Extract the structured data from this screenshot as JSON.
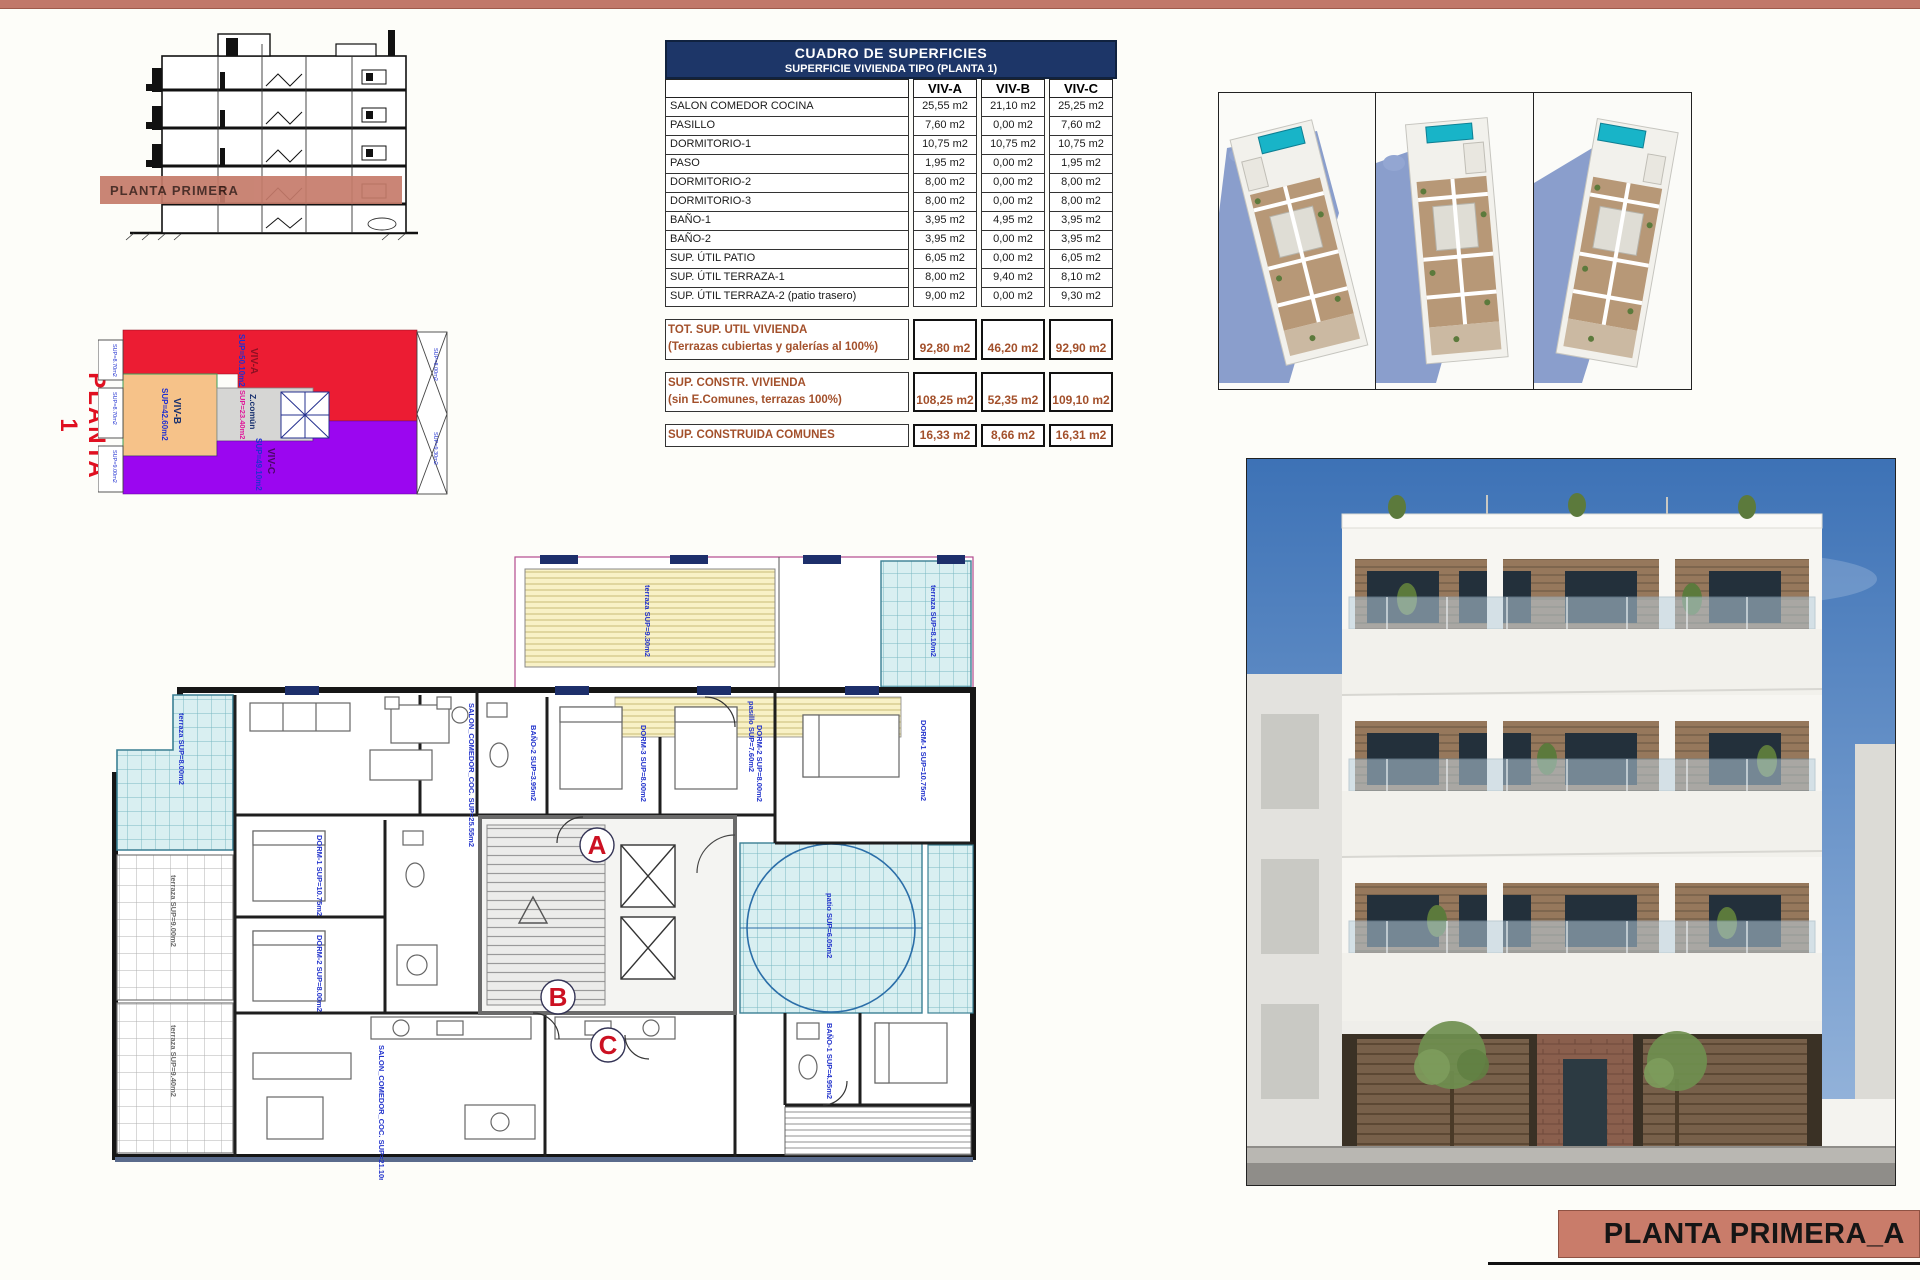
{
  "page": {
    "top_bar_color": "#c1786a",
    "accent_salmon": "#c97c6a",
    "table_header_navy": "#1d3668",
    "summary_brown": "#a3502b"
  },
  "section": {
    "band_label": "PLANTA PRIMERA"
  },
  "diagram": {
    "title": "PLANTA 1",
    "zones": {
      "viva": {
        "name": "VIV-A",
        "sup": "SUP=50.10m2",
        "color": "#ec1c33"
      },
      "vivb": {
        "name": "VIV-B",
        "sup": "SUP=42.60m2",
        "color": "#f6c289"
      },
      "zcomun": {
        "name": "Z.común",
        "sup": "SUP=23.40m2",
        "color": "#d6d6d4"
      },
      "vivc": {
        "name": "VIV-C",
        "sup": "SUP=49.10m2",
        "color": "#9b06f0"
      }
    },
    "edge_labels": {
      "left1": "SUP=8.70m2",
      "left2": "SUP=8.70m2",
      "left3": "SUP=9.00m2",
      "right1": "SUP=8.00m2",
      "right2": "SUP=9.30m2"
    }
  },
  "table": {
    "title": "CUADRO DE SUPERFICIES",
    "subtitle": "SUPERFICIE VIVIENDA TIPO  (PLANTA 1)",
    "col_a": "VIV-A",
    "col_b": "VIV-B",
    "col_c": "VIV-C",
    "rows": [
      {
        "label": "SALON COMEDOR COCINA",
        "a": "25,55 m2",
        "b": "21,10 m2",
        "c": "25,25 m2"
      },
      {
        "label": "PASILLO",
        "a": "7,60 m2",
        "b": "0,00 m2",
        "c": "7,60 m2"
      },
      {
        "label": "DORMITORIO-1",
        "a": "10,75 m2",
        "b": "10,75 m2",
        "c": "10,75 m2"
      },
      {
        "label": "PASO",
        "a": "1,95 m2",
        "b": "0,00 m2",
        "c": "1,95 m2"
      },
      {
        "label": "DORMITORIO-2",
        "a": "8,00 m2",
        "b": "0,00 m2",
        "c": "8,00 m2"
      },
      {
        "label": "DORMITORIO-3",
        "a": "8,00 m2",
        "b": "0,00 m2",
        "c": "8,00 m2"
      },
      {
        "label": "BAÑO-1",
        "a": "3,95 m2",
        "b": "4,95 m2",
        "c": "3,95 m2"
      },
      {
        "label": "BAÑO-2",
        "a": "3,95 m2",
        "b": "0,00 m2",
        "c": "3,95 m2"
      },
      {
        "label": "SUP. ÚTIL PATIO",
        "a": "6,05 m2",
        "b": "0,00 m2",
        "c": "6,05 m2"
      },
      {
        "label": "SUP. ÚTIL TERRAZA-1",
        "a": "8,00 m2",
        "b": "9,40 m2",
        "c": "8,10 m2"
      },
      {
        "label": "SUP. ÚTIL TERRAZA-2 (patio trasero)",
        "a": "9,00 m2",
        "b": "0,00 m2",
        "c": "9,30 m2"
      }
    ],
    "summary": [
      {
        "l1": "TOT. SUP. UTIL VIVIENDA",
        "l2": "(Terrazas cubiertas y galerías al 100%)",
        "a": "92,80 m2",
        "b": "46,20 m2",
        "c": "92,90 m2"
      },
      {
        "l1": "SUP. CONSTR. VIVIENDA",
        "l2": "(sin E.Comunes, terrazas 100%)",
        "a": "108,25 m2",
        "b": "52,35 m2",
        "c": "109,10 m2"
      },
      {
        "l1": "SUP. CONSTRUIDA COMUNES",
        "l2": "",
        "a": "16,33 m2",
        "b": "8,66 m2",
        "c": "16,31 m2"
      }
    ]
  },
  "floor_plan": {
    "markers": {
      "a": "A",
      "b": "B",
      "c": "C"
    },
    "labels": [
      "SALON_COMEDOR_COC. SUP=25.55m2",
      "BAÑO-2 SUP=3.95m2",
      "DORM-3 SUP=8.00m2",
      "DORM-2 SUP=8.00m2",
      "DORM-1 SUP=10.75m2",
      "pasillo SUP=7.60m2",
      "terraza SUP=8.00m2",
      "terraza SUP=9.00m2",
      "patio SUP=6.05m2",
      "DORM-1 SUP=10.75m2",
      "DORM-2 SUP=8.00m2",
      "SALON_COMEDOR_COC. SUP=21.10m2",
      "BAÑO-1 SUP=4.95m2",
      "terraza SUP=9.40m2",
      "terraza SUP=8.10m2",
      "terraza SUP=9.30m2"
    ]
  },
  "title_block": {
    "text": "PLANTA PRIMERA_A"
  }
}
